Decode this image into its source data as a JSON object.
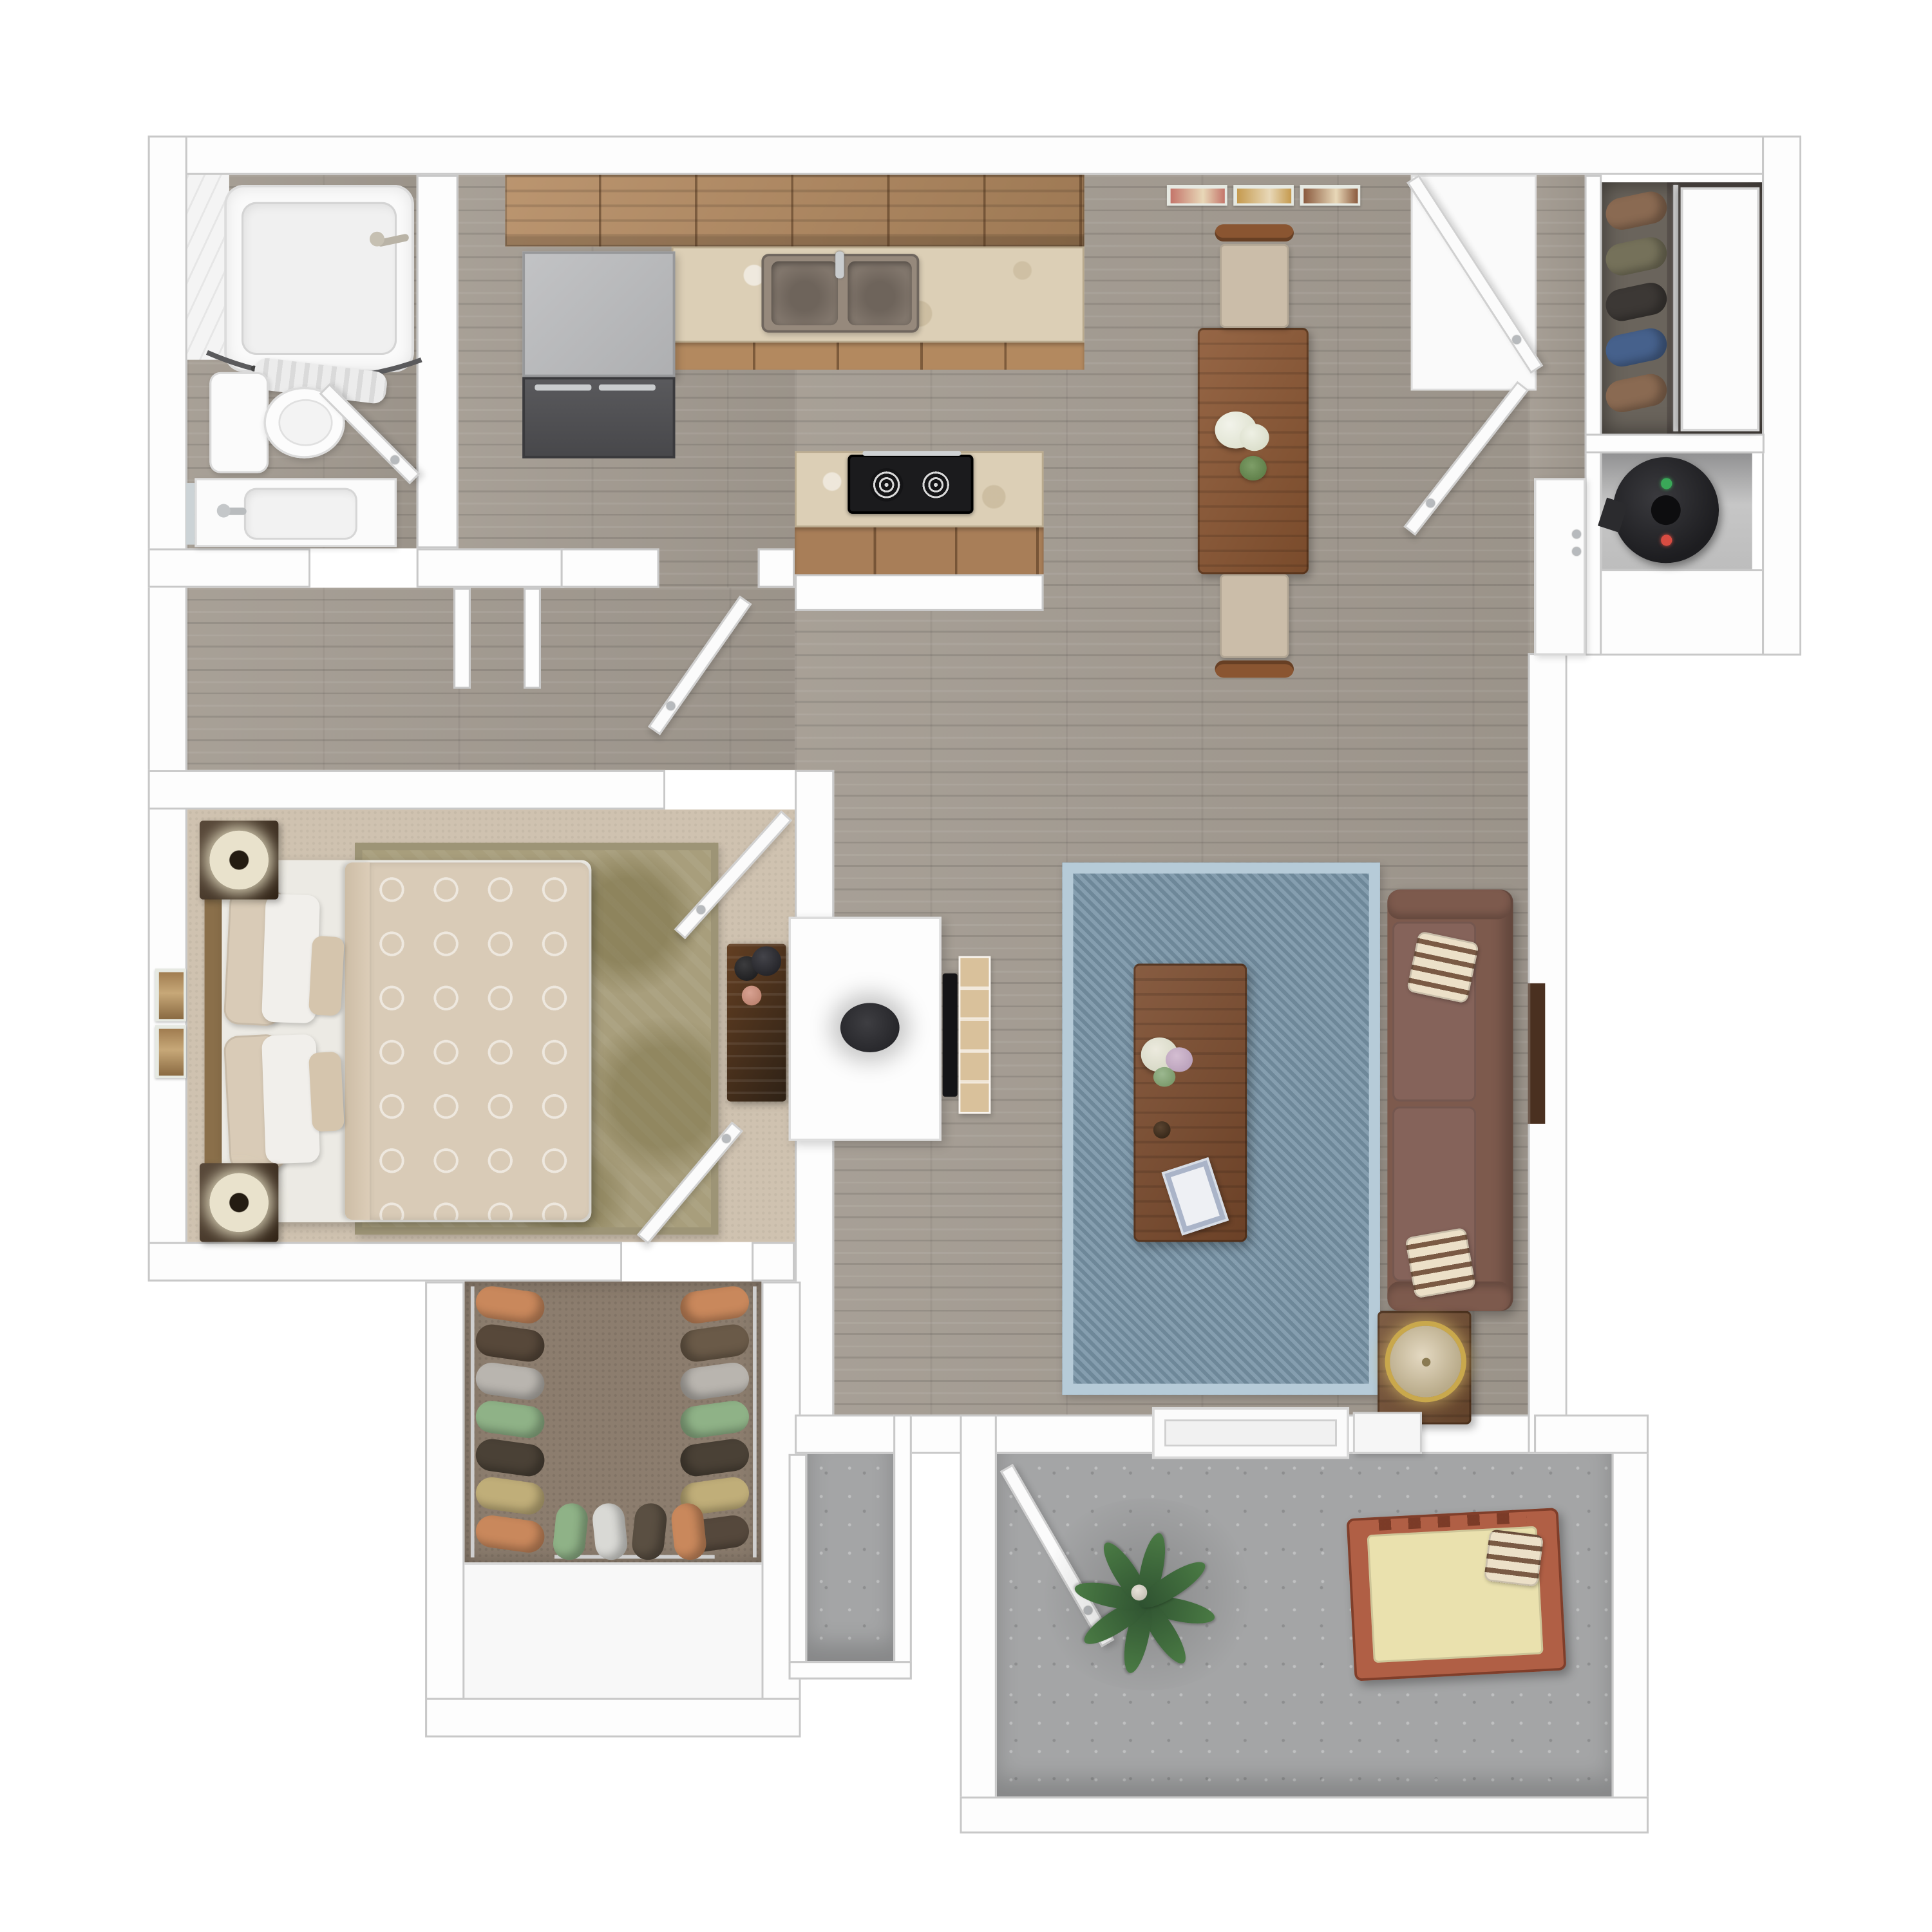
{
  "meta": {
    "image_type": "3d-rendered top-down floor plan",
    "description": "One-bedroom one-bath apartment 3D floor plan with furnished rooms and patio",
    "visible_text": []
  },
  "palette": {
    "wall": "#fdfdfd",
    "walledge": "#c8c8c8",
    "wood": "#a39b91",
    "carpet": "#cfc2b0",
    "rugolive": "#a89e7c",
    "closetcarpet": "#8c7d6e",
    "concrete": "#a4a5a6",
    "cabinet": "#b3895f",
    "counter": "#dccfb6",
    "islandwood": "#a87e58",
    "fridgetop": "#b7b8ba",
    "fridgebottom": "#4d4d50",
    "sink": "#96897c",
    "stove": "#1b1b1d",
    "diningtable": "#8a5531",
    "chair": "#cbbda9",
    "bedlinen": "#d9cbb7",
    "pillow": "#f1efeb",
    "nightwood": "#42301f",
    "lamp": "#e9e2cc",
    "sofa": "#7d5a4d",
    "sofacushion": "#85635a",
    "pillowstripebase": "#ece0c8",
    "pillowstripe": "#7a5a44",
    "coffeetable": "#7a4a2c",
    "sidetable": "#6f4b30",
    "lampgold": "#c9a84c",
    "bluerugborder": "#b6cbd8",
    "bluerug": "#7793a6",
    "tv": "#141417",
    "hearth": "#d9c19b",
    "door": "#fbfbfb",
    "dooredge": "#d0d0d0",
    "waterheater": "#232327",
    "plant": "#4a7a44",
    "plantdark": "#2e5130",
    "loungeframe": "#b05f45",
    "loungecushion": "#eae1ae"
  },
  "rooms": [
    {
      "name": "bathroom",
      "floor": "wood",
      "fixtures": [
        "bathtub with curved shower rod and curtain",
        "toilet",
        "vanity sink with mirror"
      ]
    },
    {
      "name": "kitchen",
      "floor": "wood",
      "fixtures": [
        "upper cabinets",
        "refrigerator",
        "double-basin sink",
        "marble counter",
        "cooktop island"
      ]
    },
    {
      "name": "dining-area",
      "floor": "wood",
      "fixtures": [
        "dining table",
        "2 upholstered chairs",
        "white flower bouquet",
        "green plant sprig",
        "3 wall art frames"
      ]
    },
    {
      "name": "living-room",
      "floor": "wood",
      "fixtures": [
        "blue area rug",
        "coffee table",
        "sofa with star pillows",
        "side table with gold lamp",
        "wall shelf",
        "TV console with fireplace hearth",
        "sliding patio door threshold"
      ]
    },
    {
      "name": "hallway",
      "floor": "wood",
      "fixtures": [
        "linen niche"
      ]
    },
    {
      "name": "bedroom",
      "floor": "carpet",
      "fixtures": [
        "bed",
        "2 nightstands with lamps",
        "patterned area rug",
        "dresser with decor",
        "2 wall frames"
      ]
    },
    {
      "name": "walk-in-closet",
      "floor": "carpet",
      "fixtures": [
        "hanging clothes",
        "shoe shelf"
      ]
    },
    {
      "name": "coat-closet",
      "floor": "wood",
      "fixtures": [
        "hanging clothes",
        "sliding door"
      ]
    },
    {
      "name": "utility-closet",
      "floor": "concrete",
      "fixtures": [
        "water heater"
      ]
    },
    {
      "name": "patio",
      "floor": "concrete",
      "fixtures": [
        "potted plant",
        "wooden lounge chair with cushion and striped pillow",
        "storage closet"
      ]
    }
  ],
  "doors": [
    "entry-door",
    "pantry-door",
    "bathroom-door",
    "hallway-door",
    "bedroom-door",
    "walk-in-closet-door",
    "patio-door",
    "coat-closet-sliding-door"
  ],
  "dining": {
    "wall_art_colors": [
      "#c4756a",
      "#c59a4e",
      "#8a5a3e"
    ],
    "chair_count": 2
  },
  "living": {
    "hearth_tile_count": 5,
    "sofa_pillow_count": 2
  },
  "patio": {
    "plant_leaf_count": 8
  },
  "closets": {
    "coat": {
      "colors": [
        "#8a6a52",
        "#75715a",
        "#3c3835",
        "#46618c",
        "#8a6a52"
      ]
    },
    "walk_in": {
      "left_colors": [
        "#c9885c",
        "#57483a",
        "#b9b5af",
        "#8fb287",
        "#4a4136",
        "#c0ae79",
        "#c9885c"
      ],
      "right_colors": [
        "#c9885c",
        "#6a5a48",
        "#b9b5af",
        "#8fb287",
        "#4a4136",
        "#c0ae79",
        "#55483c"
      ],
      "bottom_colors": [
        "#8fb287",
        "#d9d9d5",
        "#5a4f42",
        "#c9885c"
      ]
    }
  },
  "utility": {
    "water_heater_lights": [
      "#3aa858",
      "#d84c42"
    ]
  }
}
